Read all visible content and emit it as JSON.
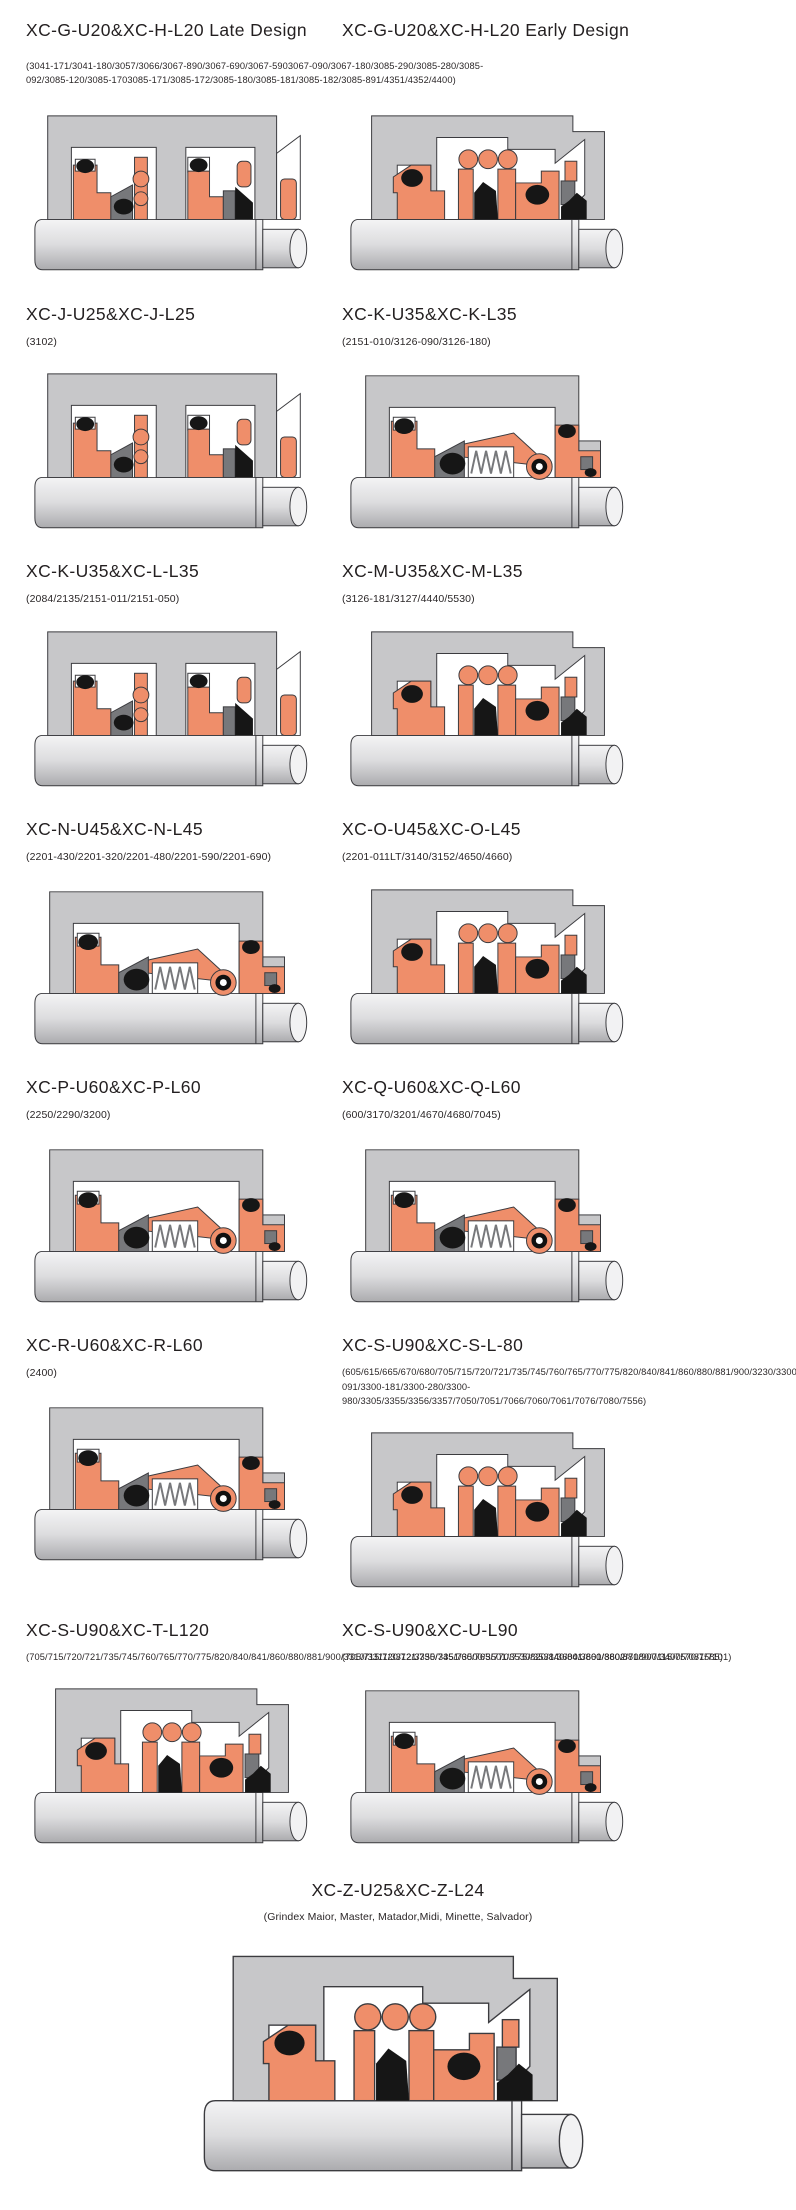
{
  "colors": {
    "seal_component_salmon": "#EF8E6A",
    "housing_gray": "#C7C7C9",
    "hardware_dark_gray": "#77787B",
    "elastomer_black": "#161616",
    "outline": "#3B3B3F",
    "text": "#231F20"
  },
  "rows": [
    {
      "left": {
        "title": "XC-G-U20&XC-H-L20 Late Design"
      },
      "right": {
        "title": "XC-G-U20&XC-H-L20 Early Design"
      },
      "shared_parts": "(3041-171/3041-180/3057/3066/3067-890/3067-690/3067-5903067-090/3067-180/3085-290/3085-280/3085-092/3085-120/3085-1703085-171/3085-172/3085-180/3085-181/3085-182/3085-891/4351/4352/4400)"
    },
    {
      "left": {
        "title": "XC-J-U25&XC-J-L25",
        "parts": "(3102)"
      },
      "right": {
        "title": "XC-K-U35&XC-K-L35",
        "parts": "(2151-010/3126-090/3126-180)"
      }
    },
    {
      "left": {
        "title": "XC-K-U35&XC-L-L35",
        "parts": "(2084/2135/2151-011/2151-050)"
      },
      "right": {
        "title": "XC-M-U35&XC-M-L35",
        "parts": "(3126-181/3127/4440/5530)"
      }
    },
    {
      "left": {
        "title": "XC-N-U45&XC-N-L45",
        "parts": "(2201-430/2201-320/2201-480/2201-590/2201-690)"
      },
      "right": {
        "title": "XC-O-U45&XC-O-L45",
        "parts": "(2201-011LT/3140/3152/4650/4660)"
      }
    },
    {
      "left": {
        "title": "XC-P-U60&XC-P-L60",
        "parts": "(2250/2290/3200)"
      },
      "right": {
        "title": "XC-Q-U60&XC-Q-L60",
        "parts": "(600/3170/3201/4670/4680/7045)"
      }
    },
    {
      "left": {
        "title": "XC-R-U60&XC-R-L60",
        "parts": "(2400)"
      },
      "right": {
        "title": "XC-S-U90&XC-S-L-80",
        "parts": "(605/615/665/670/680/705/715/720/721/735/745/760/765/770/775/820/840/841/860/880/881/900/3230/3300-091/3300-181/3300-280/3300-980/3305/3355/3356/3357/7050/7051/7066/7060/7061/7076/7080/7556)"
      }
    },
    {
      "left": {
        "title": "XC-S-U90&XC-T-L120",
        "parts": "(705/715/720/721/735/745/760/765/770/775/820/840/841/860/880/881/900/3310/3311/3312/3350/3351/3500/3501/3530/3531/3600/3601/3602/7080/7115/7570/7585)"
      },
      "right": {
        "title": "XC-S-U90&XC-U-L90",
        "parts": "(705/715/720/721/735/745/760/765/770/775/820/840/841/860/880/881/900/3400/7081/7101)"
      }
    }
  ],
  "footer_entry": {
    "title": "XC-Z-U25&XC-Z-L24",
    "parts": "(Grindex Maior, Master, Matador,Midi, Minette, Salvador)"
  }
}
